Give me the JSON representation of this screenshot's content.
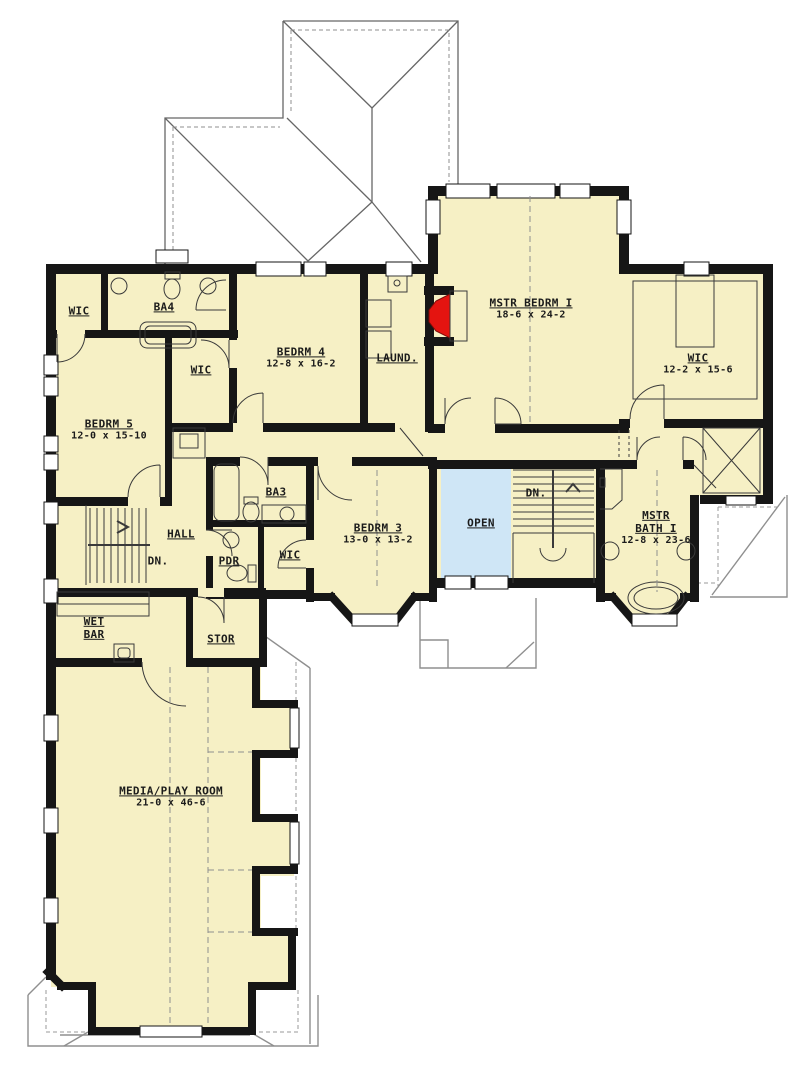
{
  "plan": {
    "type": "second-floor-plan",
    "colors": {
      "floor": "#f6f0c5",
      "open_below": "#cfe6f6",
      "wall": "#161616",
      "fireplace_red": "#e41410",
      "roof_gray": "#8f8f8f"
    },
    "rooms": {
      "wic1": {
        "name": "WIC"
      },
      "ba4": {
        "name": "BA4"
      },
      "wic2": {
        "name": "WIC"
      },
      "bedrm4": {
        "name": "BEDRM 4",
        "dims": "12-8 x 16-2"
      },
      "laund": {
        "name": "LAUND."
      },
      "mstr_bedrm": {
        "name": "MSTR BEDRM I",
        "dims": "18-6 x 24-2"
      },
      "wic_mstr": {
        "name": "WIC",
        "dims": "12-2 x 15-6"
      },
      "bedrm5": {
        "name": "BEDRM 5",
        "dims": "12-0 x 15-10"
      },
      "hall": {
        "name": "HALL"
      },
      "dn_left": {
        "name": "DN."
      },
      "ba3": {
        "name": "BA3"
      },
      "pdr": {
        "name": "PDR"
      },
      "wic3": {
        "name": "WIC"
      },
      "bedrm3": {
        "name": "BEDRM 3",
        "dims": "13-0 x 13-2"
      },
      "open": {
        "name": "OPEN"
      },
      "dn_right": {
        "name": "DN."
      },
      "mstr_bath": {
        "name_line1": "MSTR",
        "name_line2": "BATH I",
        "dims": "12-8 x 23-6"
      },
      "wet_bar": {
        "name_line1": "WET",
        "name_line2": "BAR"
      },
      "stor": {
        "name": "STOR"
      },
      "media": {
        "name": "MEDIA/PLAY ROOM",
        "dims": "21-0 x 46-6"
      }
    }
  }
}
